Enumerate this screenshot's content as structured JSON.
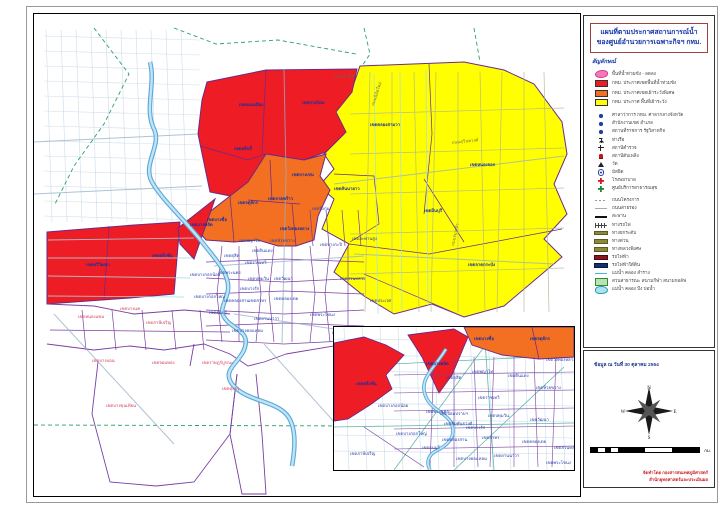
{
  "title": {
    "line1": "แผนที่ตามประกาศสถานการณ์น้ำ",
    "line2": "ของศูนย์อำนวยการเฉพาะกิจฯ กทม."
  },
  "colors": {
    "flood_red": "#EE1C25",
    "watch_special_orange": "#F36F21",
    "monitor_yellow": "#FFFF00",
    "recede_pink": "#F27BB5",
    "boundary_purple": "#7A3FA2",
    "river_blue": "#5AA7D8",
    "title_blue": "#1535A8",
    "credit_red": "#CC2020"
  },
  "legend": {
    "header": "สัญลักษณ์",
    "items": [
      {
        "icon": "pink-blob",
        "label": "พื้นที่น้ำท่วมขัง - ลดลง",
        "area": true
      },
      {
        "icon": "red-swatch",
        "label": "กทม. ประกาศเขตพื้นที่น้ำท่วมขัง",
        "area": true
      },
      {
        "icon": "orange-swatch",
        "label": "กทม. ประกาศเขตเฝ้าระวังพิเศษ",
        "area": true
      },
      {
        "icon": "yellow-swatch",
        "label": "กทม. ประกาศ พื้นที่เฝ้าระวัง",
        "area": true
      },
      {
        "icon": "dot-blue",
        "label": "ศาลาว่าการ กทม. ศาลากลางจังหวัด",
        "sp": true
      },
      {
        "icon": "dot-blue",
        "label": "สำนักงานเขต อำเภอ"
      },
      {
        "icon": "dot-blue",
        "label": "สถานที่ราชการ รัฐวิสาหกิจ"
      },
      {
        "icon": "anchor",
        "label": "ท่าเรือ"
      },
      {
        "icon": "cross-black",
        "label": "สถานีตำรวจ"
      },
      {
        "icon": "hydrant-red",
        "label": "สถานีดับเพลิง"
      },
      {
        "icon": "triangle-black",
        "label": "วัด"
      },
      {
        "icon": "circle-dot",
        "label": "มัสยิด"
      },
      {
        "icon": "cross-red",
        "label": "โรงพยาบาล"
      },
      {
        "icon": "cross-green",
        "label": "ศูนย์บริการสาธารณสุข"
      },
      {
        "icon": "line-dash-gray",
        "label": "ถนนโครงการ",
        "sp": true
      },
      {
        "icon": "line-thin-gray",
        "label": "ถนนสายรอง"
      },
      {
        "icon": "line-black",
        "label": "สะพาน"
      },
      {
        "icon": "line-rail",
        "label": "ทางรถไฟ"
      },
      {
        "icon": "line-olive",
        "label": "ทางยกระดับ"
      },
      {
        "icon": "line-olive",
        "label": "ทางด่วน"
      },
      {
        "icon": "line-olive",
        "label": "ทางหลวงพิเศษ"
      },
      {
        "icon": "line-darkred",
        "label": "รถไฟฟ้า"
      },
      {
        "icon": "line-navy",
        "label": "รถไฟฟ้าใต้ดิน"
      },
      {
        "icon": "line-cyan",
        "label": "แม่น้ำ คลอง ลำราง"
      },
      {
        "icon": "park-rect",
        "label": "สวนสาธารณะ สนามกีฬา สนามกอล์ฟ"
      },
      {
        "icon": "water-blob",
        "label": "แม่น้ำ คลอง บึง บ่อน้ำ"
      }
    ]
  },
  "info": {
    "data_date": "ข้อมูล ณ วันที่ 30 ตุลาคม 2554",
    "credit_line1": "จัดทำโดย กองสารสนเทศภูมิศาสตร์",
    "credit_line2": "สำนักยุทธศาสตร์และประเมินผล",
    "compass": [
      "N",
      "E",
      "S",
      "W"
    ],
    "scale_unit": "กม.",
    "scale_ticks": [
      {
        "v": "0",
        "p": 0
      },
      {
        "v": "135",
        "p": 0.125
      },
      {
        "v": "270",
        "p": 0.25
      },
      {
        "v": "540",
        "p": 0.5
      },
      {
        "v": "810",
        "p": 0.75
      },
      {
        "v": "1,080",
        "p": 1
      }
    ]
  },
  "map": {
    "district_labels": [
      {
        "t": "เขตดอนเมือง",
        "x": 205,
        "y": 92,
        "c": "n",
        "s": 5
      },
      {
        "t": "เขตสายไหม",
        "x": 268,
        "y": 90,
        "c": "n",
        "s": 5
      },
      {
        "t": "เขตหลักสี่",
        "x": 200,
        "y": 136,
        "c": "n"
      },
      {
        "t": "เขตบางเขน",
        "x": 258,
        "y": 162,
        "c": "n"
      },
      {
        "t": "เขตจตุจักร",
        "x": 204,
        "y": 190,
        "c": "n"
      },
      {
        "t": "เขตบางซื่อ",
        "x": 173,
        "y": 207,
        "c": "n"
      },
      {
        "t": "เขตลาดพร้าว",
        "x": 234,
        "y": 186,
        "c": "n"
      },
      {
        "t": "เขตวังทองหลาง",
        "x": 246,
        "y": 216,
        "c": "n"
      },
      {
        "t": "เขตทวีวัฒนา",
        "x": 52,
        "y": 252,
        "c": "n",
        "s": 5
      },
      {
        "t": "เขตตลิ่งชัน",
        "x": 118,
        "y": 243,
        "c": "n"
      },
      {
        "t": "เขตบางพลัด",
        "x": 156,
        "y": 212,
        "c": "n"
      },
      {
        "t": "เขตคลองสามวา",
        "x": 336,
        "y": 112,
        "c": "n",
        "s": 5.5
      },
      {
        "t": "เขตหนองจอก",
        "x": 436,
        "y": 152,
        "c": "n",
        "s": 5.5
      },
      {
        "t": "เขตมีนบุรี",
        "x": 390,
        "y": 198,
        "c": "n",
        "s": 5.5
      },
      {
        "t": "เขตคันนายาว",
        "x": 300,
        "y": 176,
        "c": "n"
      },
      {
        "t": "เขตลาดกระบัง",
        "x": 434,
        "y": 252,
        "c": "n",
        "s": 5.5
      },
      {
        "t": "เขตบึงกุ่ม",
        "x": 278,
        "y": 196,
        "c": "b"
      },
      {
        "t": "เขตสะพานสูง",
        "x": 318,
        "y": 226,
        "c": "b"
      },
      {
        "t": "เขตบางกะปิ",
        "x": 286,
        "y": 232,
        "c": "b"
      },
      {
        "t": "เขตสวนหลวง",
        "x": 306,
        "y": 266,
        "c": "b"
      },
      {
        "t": "เขตประเวศ",
        "x": 336,
        "y": 288,
        "c": "b"
      },
      {
        "t": "เขตพระโขนง",
        "x": 276,
        "y": 302,
        "c": "b"
      },
      {
        "t": "เขตบางนา",
        "x": 298,
        "y": 320,
        "c": "b"
      },
      {
        "t": "เขตห้วยขวาง",
        "x": 236,
        "y": 228,
        "c": "b"
      },
      {
        "t": "เขตดินแดง",
        "x": 218,
        "y": 238,
        "c": "b"
      },
      {
        "t": "เขตพญาไท",
        "x": 205,
        "y": 228,
        "c": "b"
      },
      {
        "t": "เขตดุสิต",
        "x": 190,
        "y": 243,
        "c": "b"
      },
      {
        "t": "เขตราชเทวี",
        "x": 211,
        "y": 250,
        "c": "b"
      },
      {
        "t": "เขตปทุมวัน",
        "x": 214,
        "y": 266,
        "c": "b"
      },
      {
        "t": "เขตวัฒนา",
        "x": 240,
        "y": 266,
        "c": "b"
      },
      {
        "t": "เขตคลองเตย",
        "x": 240,
        "y": 286,
        "c": "b"
      },
      {
        "t": "เขตบางรัก",
        "x": 206,
        "y": 276,
        "c": "b"
      },
      {
        "t": "เขตสาทร",
        "x": 215,
        "y": 288,
        "c": "b"
      },
      {
        "t": "เขตยานนาวา",
        "x": 220,
        "y": 306,
        "c": "b"
      },
      {
        "t": "เขตบางคอแหลม",
        "x": 198,
        "y": 318,
        "c": "b"
      },
      {
        "t": "เขตพระนคร",
        "x": 184,
        "y": 260,
        "c": "b"
      },
      {
        "t": "เขตคลองสาน",
        "x": 190,
        "y": 288,
        "c": "b"
      },
      {
        "t": "เขตธนบุรี",
        "x": 175,
        "y": 300,
        "c": "b"
      },
      {
        "t": "เขตบางกอกน้อย",
        "x": 156,
        "y": 262,
        "c": "b"
      },
      {
        "t": "เขตบางกอกใหญ่",
        "x": 160,
        "y": 284,
        "c": "b"
      },
      {
        "t": "เขตหนองแขม",
        "x": 44,
        "y": 304,
        "c": "r"
      },
      {
        "t": "เขตบางแค",
        "x": 86,
        "y": 296,
        "c": "r"
      },
      {
        "t": "เขตภาษีเจริญ",
        "x": 112,
        "y": 310,
        "c": "r"
      },
      {
        "t": "เขตบางบอน",
        "x": 58,
        "y": 348,
        "c": "r"
      },
      {
        "t": "เขตจอมทอง",
        "x": 118,
        "y": 350,
        "c": "r"
      },
      {
        "t": "เขตบางขุนเทียน",
        "x": 72,
        "y": 393,
        "c": "r"
      },
      {
        "t": "เขตราษฎร์บูรณะ",
        "x": 168,
        "y": 350,
        "c": "r"
      },
      {
        "t": "เขตทุ่งครุ",
        "x": 188,
        "y": 376,
        "c": "r"
      }
    ],
    "road_labels": [
      {
        "t": "ถนนนิมิตใหม่",
        "x": 340,
        "y": 92,
        "c": "k",
        "rot": -72
      },
      {
        "t": "ถนนสุวินทวงศ์",
        "x": 418,
        "y": 130,
        "c": "k",
        "rot": -6
      },
      {
        "t": "ถนนร่มเกล้า",
        "x": 420,
        "y": 232,
        "c": "k",
        "rot": -78
      },
      {
        "t": "ถนนลำลูกกา",
        "x": 300,
        "y": 64,
        "c": "k",
        "rot": -4
      }
    ]
  },
  "inset": {
    "labels": [
      {
        "t": "เขตตลิ่งชัน",
        "x": 22,
        "y": 58,
        "c": "n"
      },
      {
        "t": "เขตบางพลัด",
        "x": 92,
        "y": 38,
        "c": "n"
      },
      {
        "t": "เขตบางซื่อ",
        "x": 140,
        "y": 13,
        "c": "n"
      },
      {
        "t": "เขตจตุจักร",
        "x": 196,
        "y": 13,
        "c": "n"
      },
      {
        "t": "เขตบางกอกน้อย",
        "x": 44,
        "y": 80,
        "c": "b"
      },
      {
        "t": "เขตบางกอกใหญ่",
        "x": 62,
        "y": 108,
        "c": "b"
      },
      {
        "t": "เขตพระนคร",
        "x": 92,
        "y": 86,
        "c": "b"
      },
      {
        "t": "เขตดุสิต",
        "x": 112,
        "y": 52,
        "c": "b"
      },
      {
        "t": "เขตพญาไท",
        "x": 138,
        "y": 46,
        "c": "b"
      },
      {
        "t": "เขตราชเทวี",
        "x": 144,
        "y": 72,
        "c": "b"
      },
      {
        "t": "เขตดินแดง",
        "x": 174,
        "y": 50,
        "c": "b"
      },
      {
        "t": "เขตห้วยขวาง",
        "x": 202,
        "y": 62,
        "c": "b"
      },
      {
        "t": "เขตวังทองหลาง",
        "x": 212,
        "y": 34,
        "c": "b"
      },
      {
        "t": "เขตปทุมวัน",
        "x": 154,
        "y": 90,
        "c": "b"
      },
      {
        "t": "เขตวัฒนา",
        "x": 196,
        "y": 94,
        "c": "b"
      },
      {
        "t": "เขตคลองเตย",
        "x": 188,
        "y": 116,
        "c": "b"
      },
      {
        "t": "เขตสาทร",
        "x": 148,
        "y": 112,
        "c": "b"
      },
      {
        "t": "เขตบางรัก",
        "x": 132,
        "y": 102,
        "c": "b"
      },
      {
        "t": "เขตสัมพันธวงศ์",
        "x": 110,
        "y": 98,
        "c": "b"
      },
      {
        "t": "เขตป้อมปราบฯ",
        "x": 106,
        "y": 88,
        "c": "b"
      },
      {
        "t": "เขตคลองสาน",
        "x": 108,
        "y": 114,
        "c": "b"
      },
      {
        "t": "เขตธนบุรี",
        "x": 88,
        "y": 122,
        "c": "b"
      },
      {
        "t": "เขตภาษีเจริญ",
        "x": 16,
        "y": 128,
        "c": "b"
      },
      {
        "t": "เขตบางคอแหลม",
        "x": 122,
        "y": 133,
        "c": "b"
      },
      {
        "t": "เขตยานนาวา",
        "x": 160,
        "y": 130,
        "c": "b"
      },
      {
        "t": "เขตพระโขนง",
        "x": 212,
        "y": 137,
        "c": "b"
      },
      {
        "t": "เขตสวนหลวง",
        "x": 220,
        "y": 122,
        "c": "b"
      }
    ]
  }
}
